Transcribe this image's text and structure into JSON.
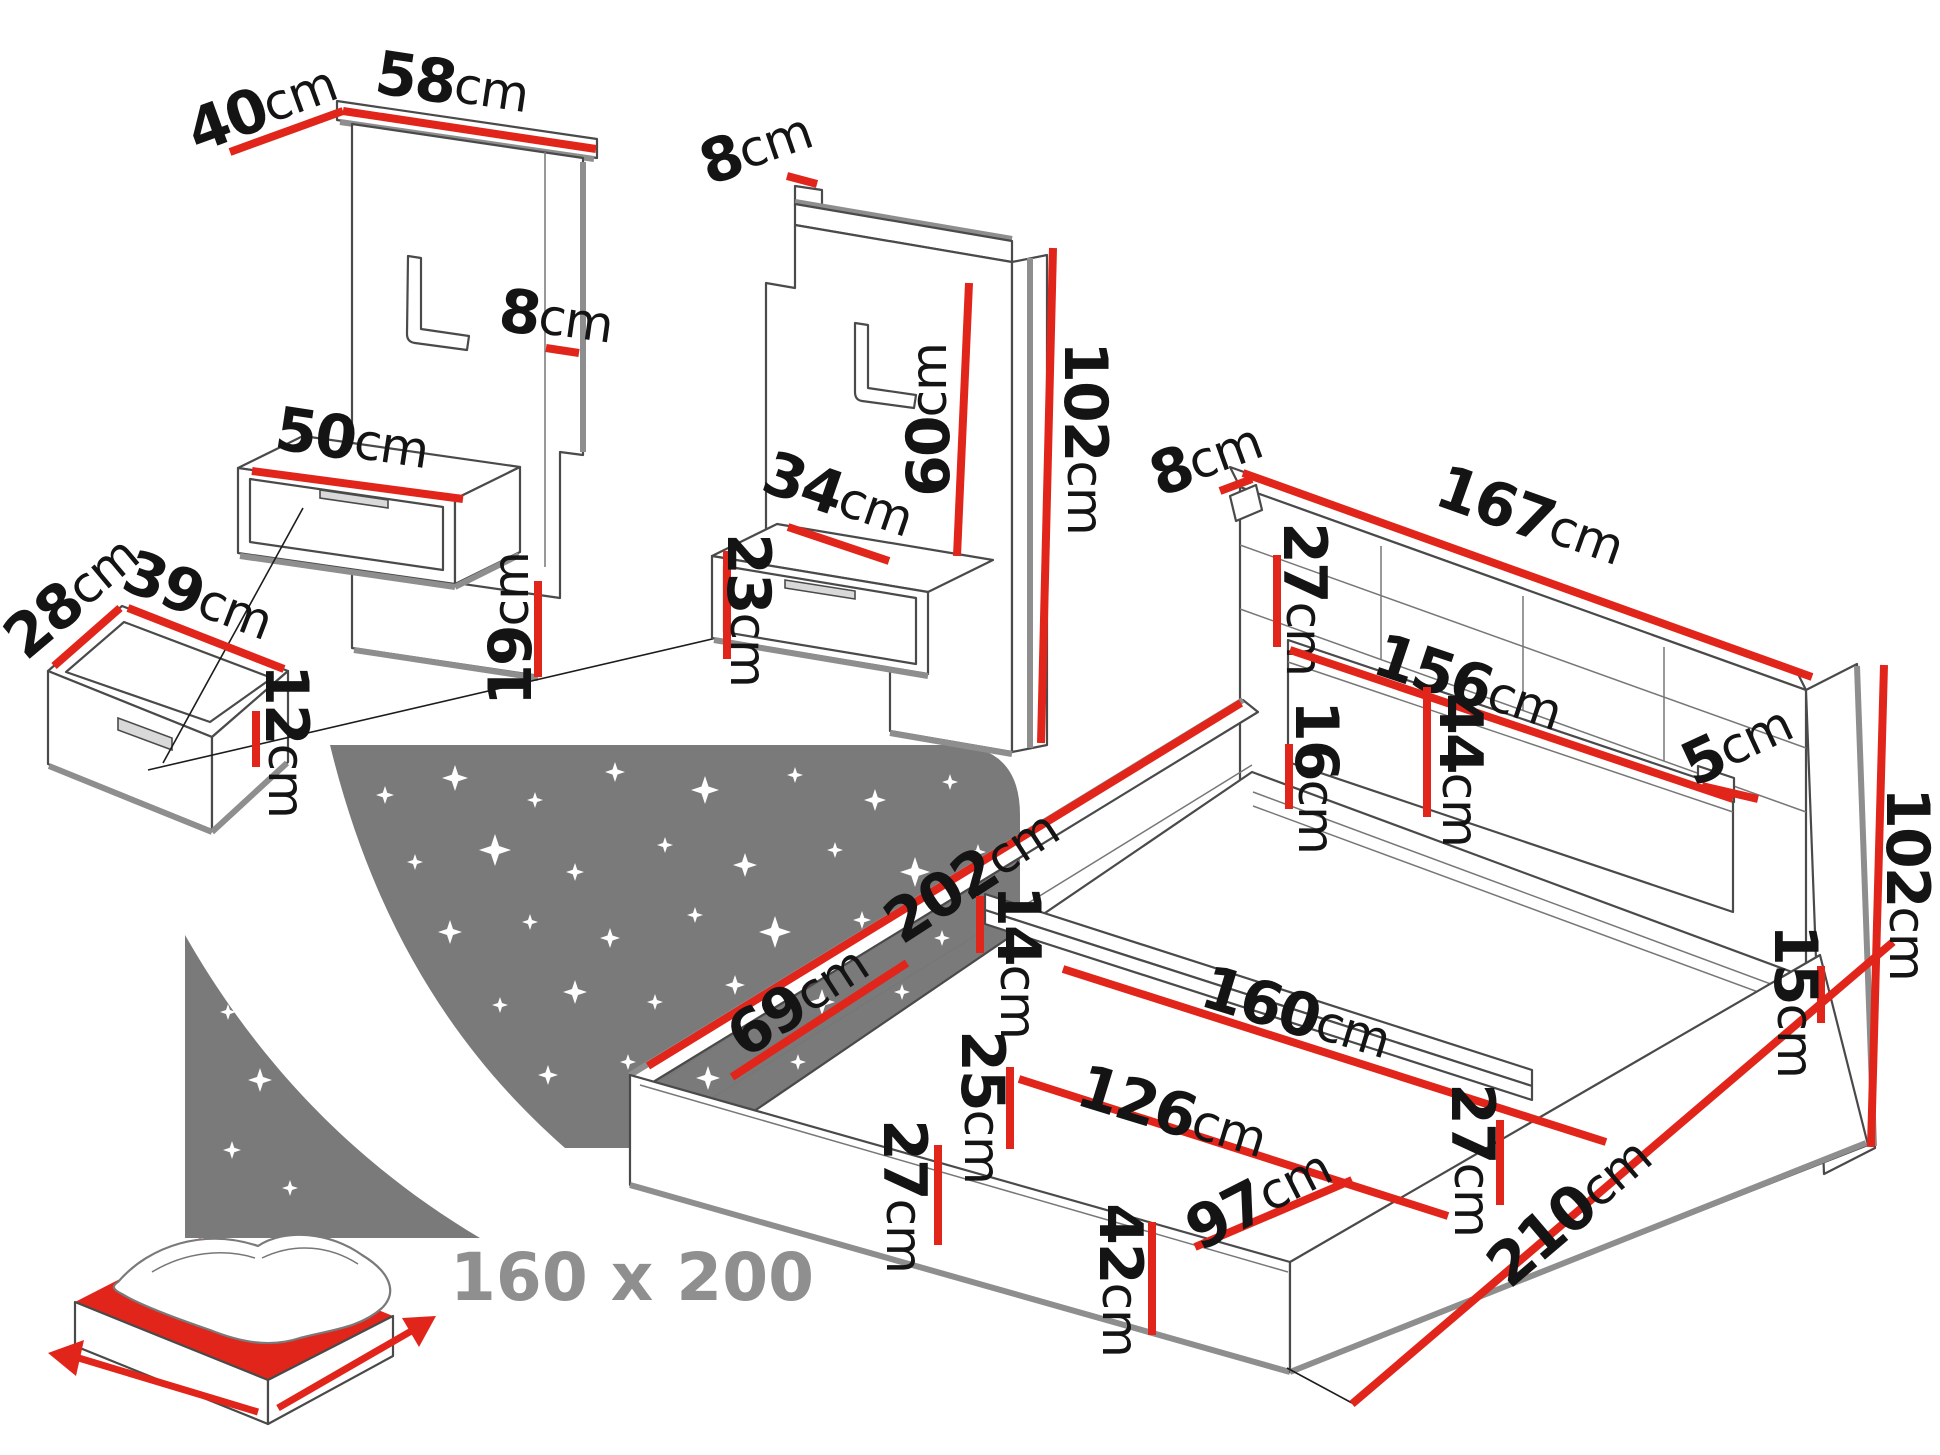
{
  "colors": {
    "dimension_red": "#e1251b",
    "outline_grey": "#4a4a4a",
    "thick_grey": "#8e8e8e",
    "label_black": "#141414",
    "logo_grey": "#7a7a7a",
    "size_text_grey": "#8f8f8f"
  },
  "logo": {
    "icon": "starry-night-bed-icon",
    "size_label": "160 x 200"
  },
  "dimensions": [
    {
      "id": "panel1-depth",
      "value": "40",
      "unit": "cm",
      "x": 262,
      "y": 108,
      "rot": -20,
      "line": [
        230,
        152,
        343,
        111
      ]
    },
    {
      "id": "panel1-width",
      "value": "58",
      "unit": "cm",
      "x": 452,
      "y": 84,
      "rot": 8.5,
      "line": [
        343,
        111,
        596,
        149
      ]
    },
    {
      "id": "panel1-thickness",
      "value": "8",
      "unit": "cm",
      "x": 556,
      "y": 318,
      "rot": 8,
      "line": [
        546,
        348,
        579,
        353
      ]
    },
    {
      "id": "panel1-shelf-width",
      "value": "50",
      "unit": "cm",
      "x": 352,
      "y": 440,
      "rot": 8.5,
      "line": [
        252,
        471,
        463,
        499
      ]
    },
    {
      "id": "panel1-foot-height",
      "value": "19",
      "unit": "cm",
      "x": 511,
      "y": 629,
      "rot": -90,
      "line": [
        538,
        581,
        538,
        677
      ]
    },
    {
      "id": "drawer-depth",
      "value": "28",
      "unit": "cm",
      "x": 72,
      "y": 597,
      "rot": -40,
      "line": [
        54,
        666,
        120,
        608
      ]
    },
    {
      "id": "drawer-width",
      "value": "39",
      "unit": "cm",
      "x": 198,
      "y": 597,
      "rot": 21,
      "line": [
        128,
        608,
        284,
        669
      ]
    },
    {
      "id": "drawer-height",
      "value": "12",
      "unit": "cm",
      "x": 286,
      "y": 741,
      "rot": 90,
      "line": [
        256,
        711,
        256,
        767
      ]
    },
    {
      "id": "panel2-thickness",
      "value": "8",
      "unit": "cm",
      "x": 756,
      "y": 148,
      "rot": -19,
      "line": [
        787,
        176,
        817,
        184
      ]
    },
    {
      "id": "panel2-inner-height",
      "value": "60",
      "unit": "cm",
      "x": 929,
      "y": 420,
      "rot": -90,
      "line": [
        969,
        283,
        957,
        556
      ]
    },
    {
      "id": "panel2-height",
      "value": "102",
      "unit": "cm",
      "x": 1085,
      "y": 438,
      "rot": 90,
      "line": [
        1053,
        248,
        1041,
        743
      ]
    },
    {
      "id": "panel2-shelf-width",
      "value": "34",
      "unit": "cm",
      "x": 838,
      "y": 496,
      "rot": 19,
      "line": [
        788,
        527,
        889,
        561
      ]
    },
    {
      "id": "panel2-shelf-height",
      "value": "23",
      "unit": "cm",
      "x": 748,
      "y": 610,
      "rot": 90,
      "line": [
        727,
        551,
        727,
        659
      ]
    },
    {
      "id": "headboard-thickness",
      "value": "8",
      "unit": "cm",
      "x": 1206,
      "y": 459,
      "rot": -20,
      "line": [
        1220,
        491,
        1252,
        479
      ]
    },
    {
      "id": "headboard-width",
      "value": "167",
      "unit": "cm",
      "x": 1530,
      "y": 517,
      "rot": 19.5,
      "line": [
        1243,
        473,
        1812,
        677
      ]
    },
    {
      "id": "headboard-slat",
      "value": "27",
      "unit": "cm",
      "x": 1304,
      "y": 599,
      "rot": 90,
      "line": [
        1277,
        555,
        1277,
        647
      ]
    },
    {
      "id": "headboard-shelf",
      "value": "156",
      "unit": "cm",
      "x": 1468,
      "y": 684,
      "rot": 18.5,
      "line": [
        1290,
        650,
        1733,
        799
      ]
    },
    {
      "id": "headboard-recess",
      "value": "44",
      "unit": "cm",
      "x": 1460,
      "y": 770,
      "rot": 90,
      "line": [
        1427,
        687,
        1427,
        817
      ]
    },
    {
      "id": "headboard-ledge",
      "value": "5",
      "unit": "cm",
      "x": 1737,
      "y": 745,
      "rot": -25,
      "line": [
        1702,
        786,
        1758,
        799
      ]
    },
    {
      "id": "headboard-lower",
      "value": "16",
      "unit": "cm",
      "x": 1316,
      "y": 777,
      "rot": 90,
      "line": [
        1289,
        744,
        1289,
        809
      ]
    },
    {
      "id": "bed-inner-length",
      "value": "202",
      "unit": "cm",
      "x": 972,
      "y": 876,
      "rot": -33,
      "line": [
        648,
        1066,
        1241,
        703
      ]
    },
    {
      "id": "mid-rail-height",
      "value": "14",
      "unit": "cm",
      "x": 1018,
      "y": 962,
      "rot": 90,
      "line": [
        980,
        896,
        980,
        953
      ]
    },
    {
      "id": "foot-section-length",
      "value": "69",
      "unit": "cm",
      "x": 798,
      "y": 1001,
      "rot": -33,
      "line": [
        732,
        1077,
        907,
        963
      ]
    },
    {
      "id": "bed-inner-width",
      "value": "160",
      "unit": "cm",
      "x": 1296,
      "y": 1014,
      "rot": 17,
      "line": [
        1063,
        969,
        1606,
        1142
      ]
    },
    {
      "id": "side-box-depth",
      "value": "25",
      "unit": "cm",
      "x": 982,
      "y": 1107,
      "rot": 90,
      "line": [
        1010,
        1067,
        1010,
        1149
      ]
    },
    {
      "id": "foot-inner-width",
      "value": "126",
      "unit": "cm",
      "x": 1172,
      "y": 1113,
      "rot": 17,
      "line": [
        1019,
        1079,
        1448,
        1216
      ]
    },
    {
      "id": "foot-box-depth",
      "value": "97",
      "unit": "cm",
      "x": 1259,
      "y": 1199,
      "rot": -27,
      "line": [
        1195,
        1247,
        1352,
        1180
      ]
    },
    {
      "id": "frame-front-height",
      "value": "27",
      "unit": "cm",
      "x": 904,
      "y": 1196,
      "rot": 90,
      "line": [
        938,
        1145,
        938,
        1245
      ]
    },
    {
      "id": "frame-base-height",
      "value": "42",
      "unit": "cm",
      "x": 1120,
      "y": 1280,
      "rot": 90,
      "line": [
        1152,
        1222,
        1152,
        1335
      ]
    },
    {
      "id": "frame-right-height",
      "value": "27",
      "unit": "cm",
      "x": 1472,
      "y": 1160,
      "rot": 90,
      "line": [
        1500,
        1120,
        1500,
        1205
      ]
    },
    {
      "id": "bed-length",
      "value": "210",
      "unit": "cm",
      "x": 1570,
      "y": 1212,
      "rot": -40.5,
      "line": [
        1352,
        1404,
        1893,
        942
      ]
    },
    {
      "id": "side-rail-height",
      "value": "15",
      "unit": "cm",
      "x": 1795,
      "y": 1001,
      "rot": 90,
      "line": [
        1821,
        966,
        1821,
        1023
      ]
    },
    {
      "id": "bed-total-height",
      "value": "102",
      "unit": "cm",
      "x": 1907,
      "y": 884,
      "rot": 90,
      "line": [
        1884,
        665,
        1871,
        1147
      ]
    }
  ]
}
